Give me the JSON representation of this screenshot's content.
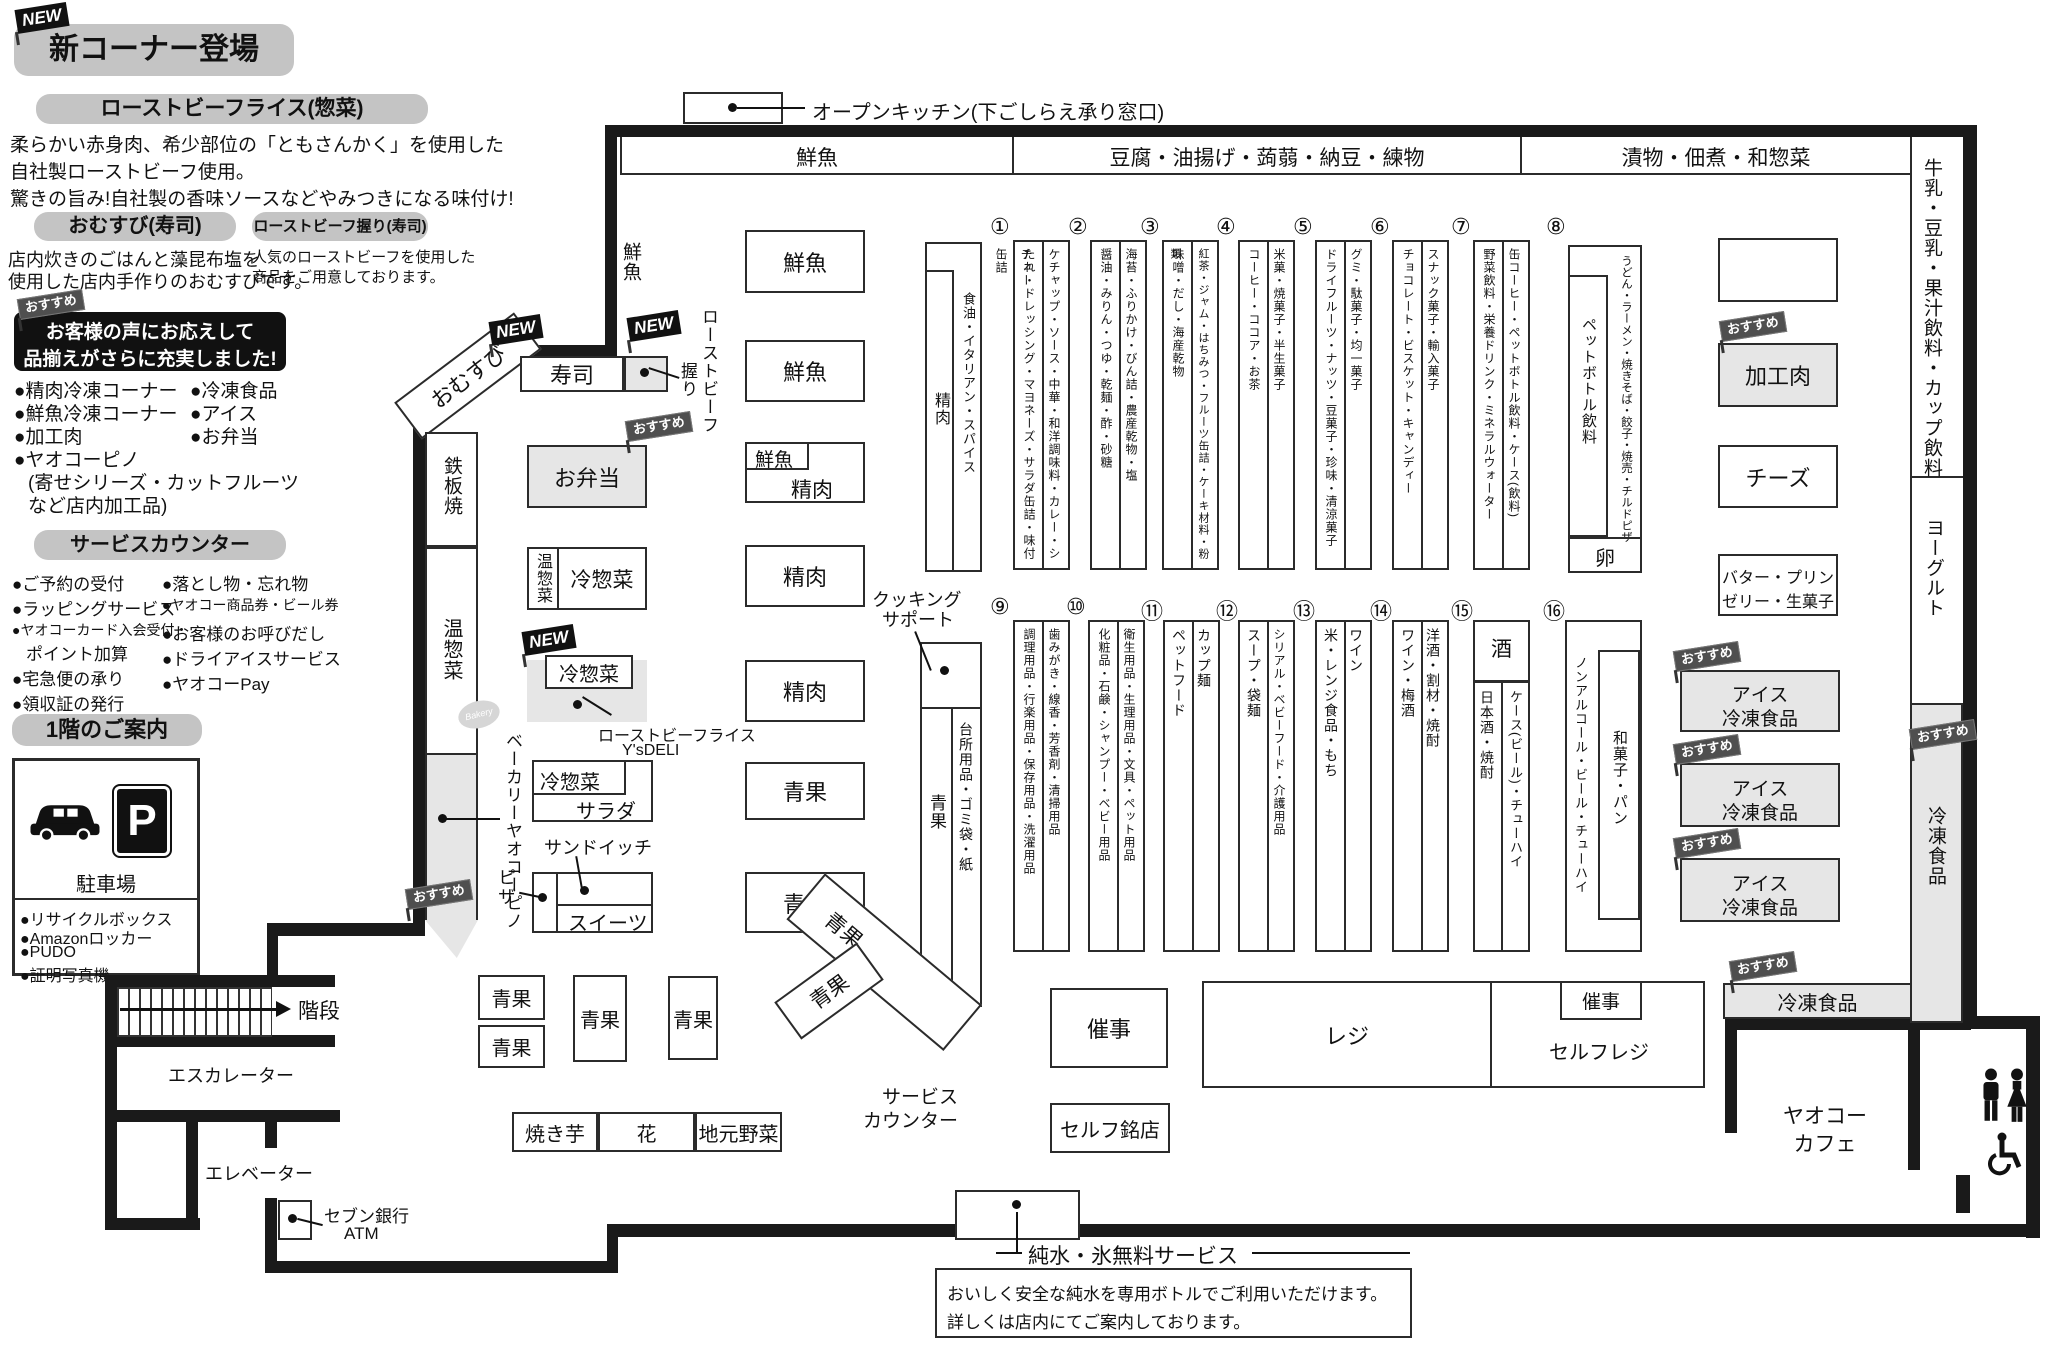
{
  "info": {
    "new_flag": "NEW",
    "osusume_flag": "おすすめ",
    "new_corner_title": "新コーナー登場",
    "rb_rice": {
      "title": "ローストビーフライス(惣菜)",
      "line1": "柔らかい赤身肉、希少部位の「ともさんかく」を使用した",
      "line2": "自社製ローストビーフ使用。",
      "line3": "驚きの旨み!自社製の香味ソースなどやみつきになる味付け!"
    },
    "omusubi": {
      "title": "おむすび(寿司)",
      "line1": "店内炊きのごはんと藻昆布塩を",
      "line2": "使用した店内手作りのおむすびです。"
    },
    "rb_nigiri": {
      "title": "ローストビーフ握り(寿司)",
      "line1": "人気のローストビーフを使用した",
      "line2": "商品をご用意しております。"
    },
    "voice_banner": {
      "line1": "お客様の声にお応えして",
      "line2": "品揃えがさらに充実しました!"
    },
    "expanded": {
      "c1r1": "●精肉冷凍コーナー",
      "c2r1": "●冷凍食品",
      "c1r2": "●鮮魚冷凍コーナー",
      "c2r2": "●アイス",
      "c1r3": "●加工肉",
      "c2r3": "●お弁当",
      "c1r4": "●ヤオコーピノ",
      "c1r5": "(寄せシリーズ・カットフルーツ",
      "c1r6": "など店内加工品)"
    },
    "service_counter": {
      "title": "サービスカウンター",
      "l1": "●ご予約の受付",
      "l2": "●ラッピングサービス",
      "l3": "●ヤオコーカード入会受付・",
      "l4": "ポイント加算",
      "l5": "●宅急便の承り",
      "l6": "●領収証の発行",
      "r1": "●落とし物・忘れ物",
      "r2": "●ヤオコー商品券・ビール券",
      "r3": "●お客様のお呼びだし",
      "r4": "●ドライアイスサービス",
      "r5": "●ヤオコーPay"
    },
    "floor_guide": {
      "title": "1階のご案内",
      "parking": "駐車場",
      "p_sign": "P",
      "i1": "●リサイクルボックス",
      "i2": "●Amazonロッカー",
      "i3": "●PUDO",
      "i4": "●証明写真機"
    }
  },
  "map": {
    "open_kitchen": "オープンキッチン(下ごしらえ承り窓口)",
    "top_sections": [
      "鮮魚",
      "豆腐・油揚げ・蒟蒻・納豆・練物",
      "漬物・佃煮・和惣菜"
    ],
    "right_sections": {
      "milk": "牛乳・豆乳・果汁飲料・カップ飲料",
      "yogurt": "ヨーグルト",
      "frozen": "冷凍食品"
    },
    "labels": {
      "sengyo": "鮮魚",
      "seiniku": "精肉",
      "seika": "青果",
      "obento": "お弁当",
      "onsozai": "温惣菜",
      "reisozai": "冷惣菜",
      "salad": "サラダ",
      "sandwich": "サンドイッチ",
      "pizza": "ピザ",
      "sweets": "スイーツ",
      "sushi": "寿司",
      "nigiri": "握り",
      "roast_beef": "ローストビーフ",
      "omusubi": "おむすび",
      "teppan": "鉄板焼",
      "bakery": "ベーカリーヤオコーピノ",
      "bakery_logo": "Bakery",
      "rb_rice": "ローストビーフライス",
      "ysdeli": "Y'sDELI",
      "cooking1": "クッキング",
      "cooking2": "サポート",
      "shokuyu": "食油・イタリアン・スパイス",
      "daidokoro": "台所用品・ゴミ袋・紙",
      "yakiimo": "焼き芋",
      "hana": "花",
      "jimoto": "地元野菜",
      "svc1": "サービス",
      "svc2": "カウンター",
      "saiji": "催事",
      "reji": "レジ",
      "selfreji": "セルフレジ",
      "selfmeiten": "セルフ銘店",
      "kaidan": "階段",
      "esc": "エスカレーター",
      "elev": "エレベーター",
      "seven": "セブン銀行",
      "atm": "ATM",
      "cafe1": "ヤオコー",
      "cafe2": "カフェ",
      "kakoniku": "加工肉",
      "cheese": "チーズ",
      "butter1": "バター・プリン",
      "butter2": "ゼリー・生菓子",
      "ice1": "アイス",
      "ice2": "冷凍食品",
      "frozen": "冷凍食品",
      "egg": "卵",
      "sake": "酒"
    },
    "aisles_top": [
      {
        "no": "①",
        "left": "たれ・ドレッシング・マヨネーズ・サラダ缶詰・味付缶詰",
        "right": "ケチャップ・ソース・中華・和洋調味料・カレー・シチュー"
      },
      {
        "no": "②",
        "left": "醤油・みりん・つゆ・乾麺・酢・砂糖",
        "right": "海苔・ふりかけ・びん詰・農産乾物・塩"
      },
      {
        "no": "③",
        "left": "味噌・だし・海産乾物",
        "right": "紅茶・ジャム・はちみつ・フルーツ缶詰・ケーキ材料・粉類"
      },
      {
        "no": "④",
        "left": "コーヒー・ココア・お茶",
        "right": "米菓・焼菓子・半生菓子"
      },
      {
        "no": "⑤",
        "left": "ドライフルーツ・ナッツ・豆菓子・珍味・清涼菓子",
        "right": "グミ・駄菓子・均一菓子"
      },
      {
        "no": "⑥",
        "left": "チョコレート・ビスケット・キャンディー",
        "right": "スナック菓子・輸入菓子"
      },
      {
        "no": "⑦",
        "left": "野菜飲料・栄養ドリンク・ミネラルウォーター",
        "right": "缶コーヒー・ペットボトル飲料・ケース(飲料)"
      },
      {
        "no": "⑧",
        "left": "ペットボトル飲料",
        "right": "うどん・ラーメン・焼きそば・餃子・焼売・チルドピザ",
        "bottom": "卵"
      }
    ],
    "aisles_bottom": [
      {
        "no": "⑨",
        "left": "調理用品・行楽用品・保存用品・洗濯用品",
        "right": "歯みがき・線香・芳香剤・清掃用品"
      },
      {
        "no": "⑩",
        "left": "化粧品・石鹸・シャンプー・ベビー用品",
        "right": "衛生用品・生理用品・文具・ペット用品"
      },
      {
        "no": "⑪",
        "left": "ペットフード",
        "right": "カップ麺"
      },
      {
        "no": "⑫",
        "left": "スープ・袋麺",
        "right": "シリアル・ベビーフード・介護用品"
      },
      {
        "no": "⑬",
        "left": "米・レンジ食品・もち",
        "right": "ワイン"
      },
      {
        "no": "⑭",
        "left": "ワイン・梅酒",
        "right": "洋酒・割材・焼酎"
      },
      {
        "no": "⑮",
        "top": "酒",
        "left": "日本酒・焼酎",
        "right": "ケース(ビール)・チューハイ"
      },
      {
        "no": "⑯",
        "left": "ノンアルコール・ビール・チューハイ",
        "right": "和菓子・パン"
      }
    ],
    "pure_water": {
      "title": "純水・氷無料サービス",
      "line1": "おいしく安全な純水を専用ボトルでご利用いただけます。",
      "line2": "詳しくは店内にてご案内しております。"
    }
  }
}
